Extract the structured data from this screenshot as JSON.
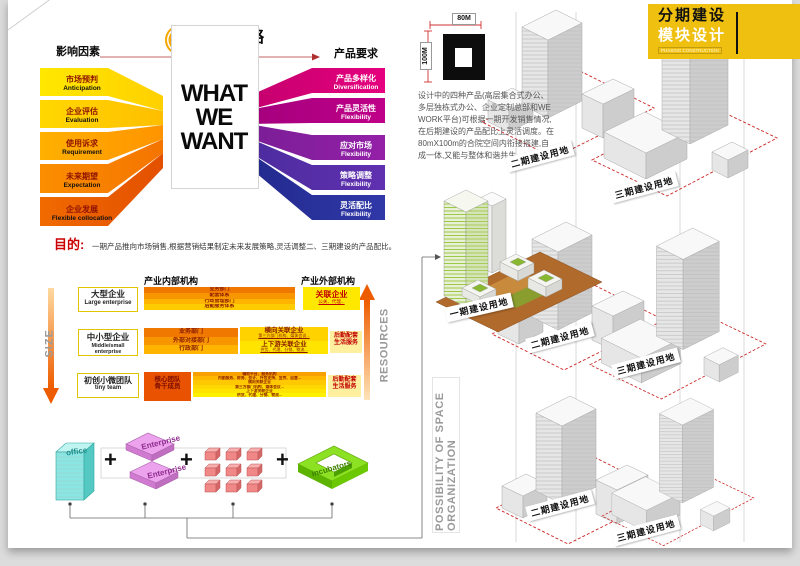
{
  "strategy": {
    "logo": "WE",
    "title": "营销策略",
    "left_header": "影响因素",
    "right_header": "产品要求",
    "what_we_want": [
      "WHAT",
      "WE",
      "WANT"
    ],
    "left_factors": [
      {
        "zh": "市场预判",
        "en": "Anticipation"
      },
      {
        "zh": "企业评估",
        "en": "Evaluation"
      },
      {
        "zh": "使用诉求",
        "en": "Requirement"
      },
      {
        "zh": "未来期望",
        "en": "Expectation"
      },
      {
        "zh": "企业发展",
        "en": "Flexible collocation"
      }
    ],
    "right_factors": [
      {
        "zh": "产品多样化",
        "en": "Diversification"
      },
      {
        "zh": "产品灵活性",
        "en": "Flexibility"
      },
      {
        "zh": "应对市场",
        "en": "Flexibility"
      },
      {
        "zh": "策略调整",
        "en": "Flexibility"
      },
      {
        "zh": "灵活配比",
        "en": "Flexibility"
      }
    ]
  },
  "purpose": {
    "label": "目的:",
    "text": "一期产品推向市场销售,根据营销结果制定未来发展策略,灵活调整二、三期建设的产品配比。"
  },
  "org": {
    "internal_header": "产业内部机构",
    "external_header": "产业外部机构",
    "size_label": "SIZE",
    "resources_label": "RESOURCES",
    "large": {
      "zh": "大型企业",
      "en": "Large enterprise",
      "bars": [
        "业务部门",
        "配套体系",
        "行政管理部门",
        "后勤服务体系"
      ],
      "external_title": "关联企业",
      "external_sub": "公关、代理..."
    },
    "medium": {
      "zh": "中小型企业",
      "en": "Middle/small enterprise",
      "bars": [
        "业务部门",
        "外部对接部门",
        "行政部门"
      ],
      "lateral_title": "横向关联企业",
      "lateral_sub": "第三方部门机构、媒体会议...",
      "updown_title": "上下游关联企业",
      "updown_sub": "供货、代理、分销、物流...",
      "support": "后勤配套\n生活服务"
    },
    "tiny": {
      "zh": "初创小微团队",
      "en": "tiny team",
      "core": "核心团队\n骨干成员",
      "lines": [
        "辅助平台、服务机构",
        "内勤服务、财务、会计、外包支持、宣传、运营...",
        "横向关联企业",
        "第三方部门机构、媒体会议...",
        "上下游关联企业",
        "供货、代理、分销、物流..."
      ],
      "support": "后勤配套\n生活服务"
    }
  },
  "modules": {
    "office": "office",
    "enterprise1": "Enterprise",
    "enterprise2": "Enterprise",
    "incubators": "incubators",
    "plus": "+",
    "possibility": "POSSIBILITY OF SPACE ORGANIZATION"
  },
  "phasing": {
    "banner": {
      "line1": "分期建设",
      "line2": "模块设计",
      "sub": "PHASING CONSTRUCTION"
    },
    "dims": {
      "width": "80M",
      "height": "100M"
    },
    "description": "设计中的四种产品(高层集合式办公、多层独栋式办公、企业定制总部和WE WORK平台)可根据一期开发销售情况,在后期建设的产品配比上灵活调度。在80mX100m的合院空间内衔接搭建,自成一体,又能与整体和谐共生。",
    "phase1_label": "一期建设用地",
    "phase2_label": "二期建设用地",
    "phase3_label": "三期建设用地"
  }
}
